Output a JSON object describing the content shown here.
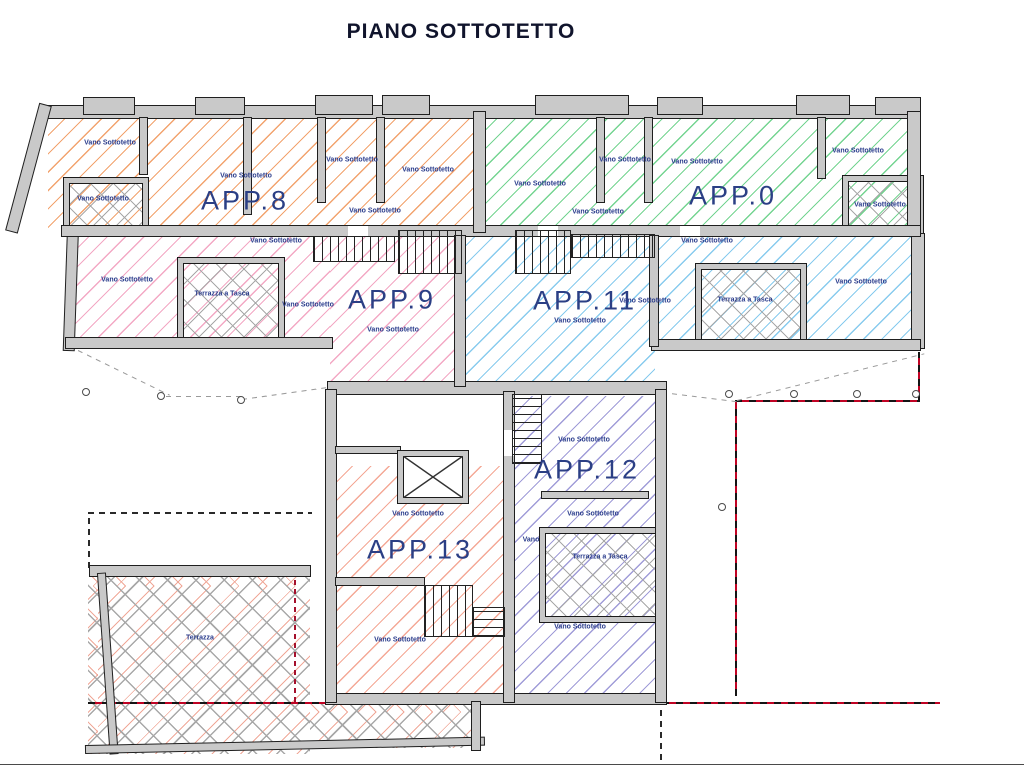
{
  "title": "PIANO SOTTOTETTO",
  "colors": {
    "app8": "#f2a36e",
    "app0": "#74d491",
    "app9": "#f3a8c4",
    "app11": "#88cbee",
    "app12": "#a09cd8",
    "app13": "#f4a896",
    "crosshatch_gray": "#a8a8a8",
    "terrazza_red": "#f0a898",
    "boundary_red": "#c00324",
    "label_navy": "#2a3c8c"
  },
  "plan": {
    "apartment_labels": [
      {
        "id": "app8",
        "text": "APP.8",
        "x": 245,
        "y": 201
      },
      {
        "id": "app0",
        "text": "APP.0",
        "x": 733,
        "y": 196
      },
      {
        "id": "app9",
        "text": "APP.9",
        "x": 392,
        "y": 300
      },
      {
        "id": "app11",
        "text": "APP.11",
        "x": 585,
        "y": 301
      },
      {
        "id": "app12",
        "text": "APP.12",
        "x": 587,
        "y": 470
      },
      {
        "id": "app13",
        "text": "APP.13",
        "x": 420,
        "y": 550
      }
    ],
    "room_labels": [
      {
        "text": "Vano Sottotetto",
        "zone": "app8",
        "x": 110,
        "y": 143
      },
      {
        "text": "Vano Sottotetto",
        "zone": "app8",
        "x": 103,
        "y": 199
      },
      {
        "text": "Vano Sottotetto",
        "zone": "app8",
        "x": 246,
        "y": 176
      },
      {
        "text": "Vano Sottotetto",
        "zone": "app8",
        "x": 352,
        "y": 160
      },
      {
        "text": "Vano Sottotetto",
        "zone": "app8",
        "x": 428,
        "y": 170
      },
      {
        "text": "Vano Sottotetto",
        "zone": "app8",
        "x": 375,
        "y": 211
      },
      {
        "text": "Vano Sottotetto",
        "zone": "app0",
        "x": 540,
        "y": 184
      },
      {
        "text": "Vano Sottotetto",
        "zone": "app0",
        "x": 625,
        "y": 160
      },
      {
        "text": "Vano Sottotetto",
        "zone": "app0",
        "x": 697,
        "y": 162
      },
      {
        "text": "Vano Sottotetto",
        "zone": "app0",
        "x": 598,
        "y": 212
      },
      {
        "text": "Vano Sottotetto",
        "zone": "app0",
        "x": 858,
        "y": 151
      },
      {
        "text": "Vano Sottotetto",
        "zone": "app0",
        "x": 880,
        "y": 205
      },
      {
        "text": "Vano Sottotetto",
        "zone": "app9",
        "x": 276,
        "y": 241
      },
      {
        "text": "Vano Sottotetto",
        "zone": "app9",
        "x": 127,
        "y": 280
      },
      {
        "text": "Terrazza a Tasca",
        "zone": "app9",
        "x": 222,
        "y": 294
      },
      {
        "text": "Vano Sottotetto",
        "zone": "app9",
        "x": 308,
        "y": 305
      },
      {
        "text": "Vano Sottotetto",
        "zone": "app9",
        "x": 393,
        "y": 330
      },
      {
        "text": "Vano Sottotetto",
        "zone": "app11",
        "x": 707,
        "y": 241
      },
      {
        "text": "Vano Sottotetto",
        "zone": "app11",
        "x": 580,
        "y": 321
      },
      {
        "text": "Vano Sottotetto",
        "zone": "app11",
        "x": 645,
        "y": 301
      },
      {
        "text": "Terrazza a Tasca",
        "zone": "app11",
        "x": 745,
        "y": 300
      },
      {
        "text": "Vano Sottotetto",
        "zone": "app11",
        "x": 861,
        "y": 282
      },
      {
        "text": "Vano Sottotetto",
        "zone": "app12",
        "x": 584,
        "y": 440
      },
      {
        "text": "Vano Sottotetto",
        "zone": "app12",
        "x": 593,
        "y": 514
      },
      {
        "text": "Vano",
        "zone": "app12",
        "x": 531,
        "y": 540
      },
      {
        "text": "Terrazza a Tasca",
        "zone": "app12",
        "x": 600,
        "y": 557
      },
      {
        "text": "Vano Sottotetto",
        "zone": "app12",
        "x": 580,
        "y": 627
      },
      {
        "text": "Vano Sottotetto",
        "zone": "app13",
        "x": 418,
        "y": 514
      },
      {
        "text": "Vano Sottotetto",
        "zone": "app13",
        "x": 400,
        "y": 640
      },
      {
        "text": "Terrazza",
        "zone": "terrazza",
        "x": 200,
        "y": 638
      }
    ]
  }
}
